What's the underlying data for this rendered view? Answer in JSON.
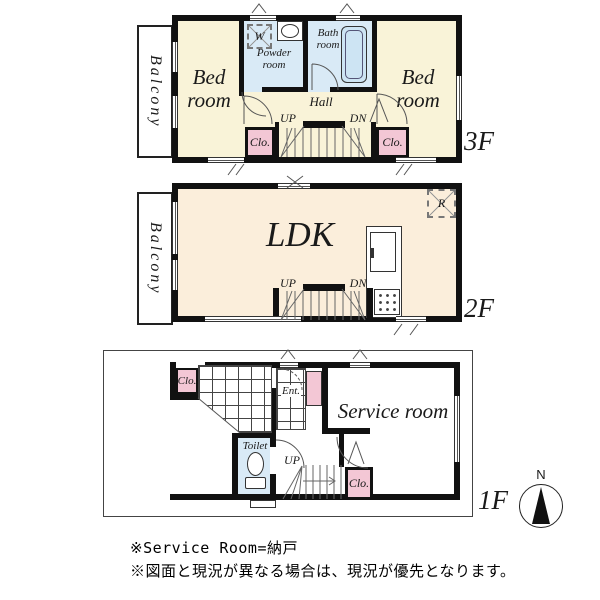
{
  "floors": {
    "f3": {
      "label": "3F",
      "balcony": "Balcony",
      "bedroom_left": "Bed room",
      "bedroom_right": "Bed room",
      "powder_room": "Powder room",
      "bath_room": "Bath room",
      "hall": "Hall",
      "up": "UP",
      "down": "DN",
      "closet_left": "Clo.",
      "closet_right": "Clo.",
      "washer": "W"
    },
    "f2": {
      "label": "2F",
      "balcony": "Balcony",
      "ldk": "LDK",
      "up": "UP",
      "down": "DN",
      "refrigerator": "R"
    },
    "f1": {
      "label": "1F",
      "entrance": "Ent.",
      "service_room": "Service room",
      "toilet": "Toilet",
      "up": "UP",
      "closet_upper": "Clo.",
      "closet_lower": "Clo."
    }
  },
  "compass": {
    "north_label": "N"
  },
  "notes": [
    "※Service Room=納戸",
    "※図面と現況が異なる場合は、現況が優先となります。"
  ],
  "colors": {
    "bedroom_cream": "#f9f3d8",
    "ldk_cream": "#fbeedb",
    "closet_pink": "#f3c7d5",
    "wet_area_blue": "#d9eaf6",
    "tub_blue": "#cde4f3",
    "wall_black": "#111111"
  }
}
